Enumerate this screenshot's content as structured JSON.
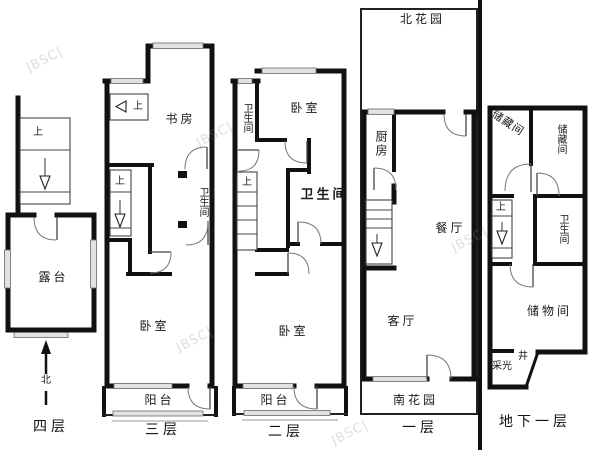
{
  "watermark": {
    "text": "JBSC|"
  },
  "plans": {
    "f4": {
      "label": "四层",
      "terrace": "露台",
      "stair_up": "上",
      "north": "北"
    },
    "f3": {
      "label": "三层",
      "study": "书房",
      "stair_up_top": "上",
      "stair_up_mid": "上",
      "bathroom": "卫生间",
      "bedroom": "卧室",
      "balcony": "阳台"
    },
    "f2": {
      "label": "二层",
      "bathroom_top": "卫生间",
      "bedroom_top": "卧室",
      "stair_up": "上",
      "bathroom_mid": "卫生间",
      "bedroom_bottom": "卧室",
      "balcony": "阳台"
    },
    "f1": {
      "label": "一层",
      "north_garden": "北花园",
      "kitchen": "厨房",
      "dining": "餐厅",
      "living": "客厅",
      "south_garden": "南花园"
    },
    "b1": {
      "label": "地下一层",
      "storage_a": "储藏间",
      "storage_b": "储藏间",
      "stair_up": "上",
      "bathroom": "卫生间",
      "storeroom": "储物间",
      "lightwell_a": "采光",
      "lightwell_b": "井"
    }
  }
}
